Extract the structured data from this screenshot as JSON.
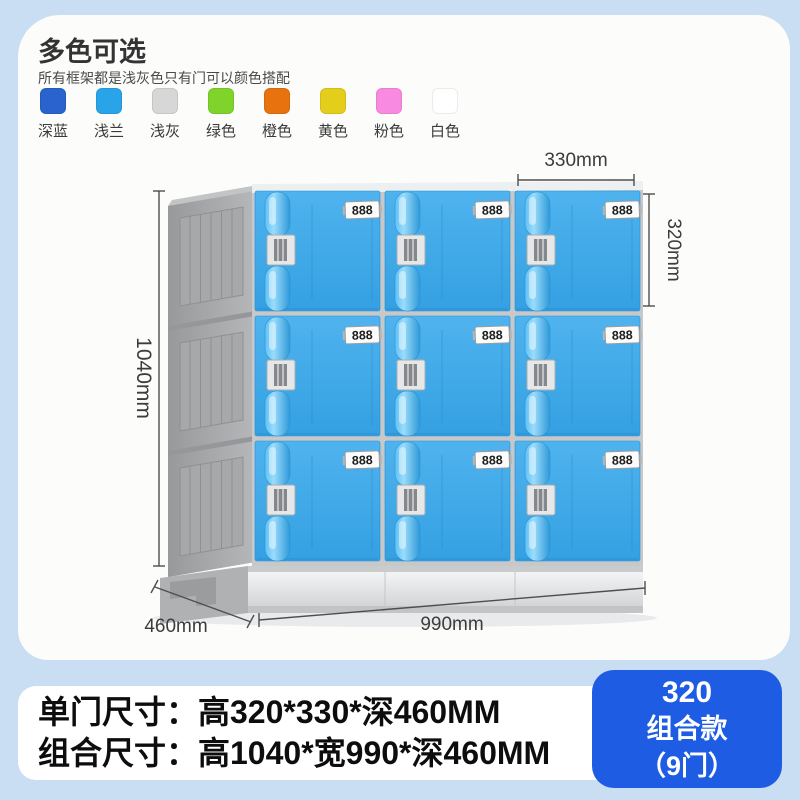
{
  "colors_section": {
    "title": "多色可选",
    "subtitle": "所有框架都是浅灰色只有门可以颜色搭配",
    "items": [
      {
        "label": "深蓝",
        "hex": "#2a63cd"
      },
      {
        "label": "浅兰",
        "hex": "#29a4e9"
      },
      {
        "label": "浅灰",
        "hex": "#d7d7d7"
      },
      {
        "label": "绿色",
        "hex": "#7fd32a"
      },
      {
        "label": "橙色",
        "hex": "#e8720e"
      },
      {
        "label": "黄色",
        "hex": "#e5cd1b"
      },
      {
        "label": "粉色",
        "hex": "#f98ae1"
      },
      {
        "label": "白色",
        "hex": "#ffffff"
      }
    ]
  },
  "diagram": {
    "door_number": "888",
    "door_color": "#3fa9e9",
    "frame_color": "#a9aaac",
    "dimensions": {
      "door_width": "330mm",
      "door_height": "320mm",
      "total_height": "1040mm",
      "total_width": "990mm",
      "depth": "460mm"
    }
  },
  "footer": {
    "line1": "单门尺寸：高320*330*深460MM",
    "line2": "组合尺寸：高1040*宽990*深460MM"
  },
  "badge": {
    "bg": "#1d5ce3",
    "line1": "320",
    "line2": "组合款",
    "line3": "（9门）"
  }
}
